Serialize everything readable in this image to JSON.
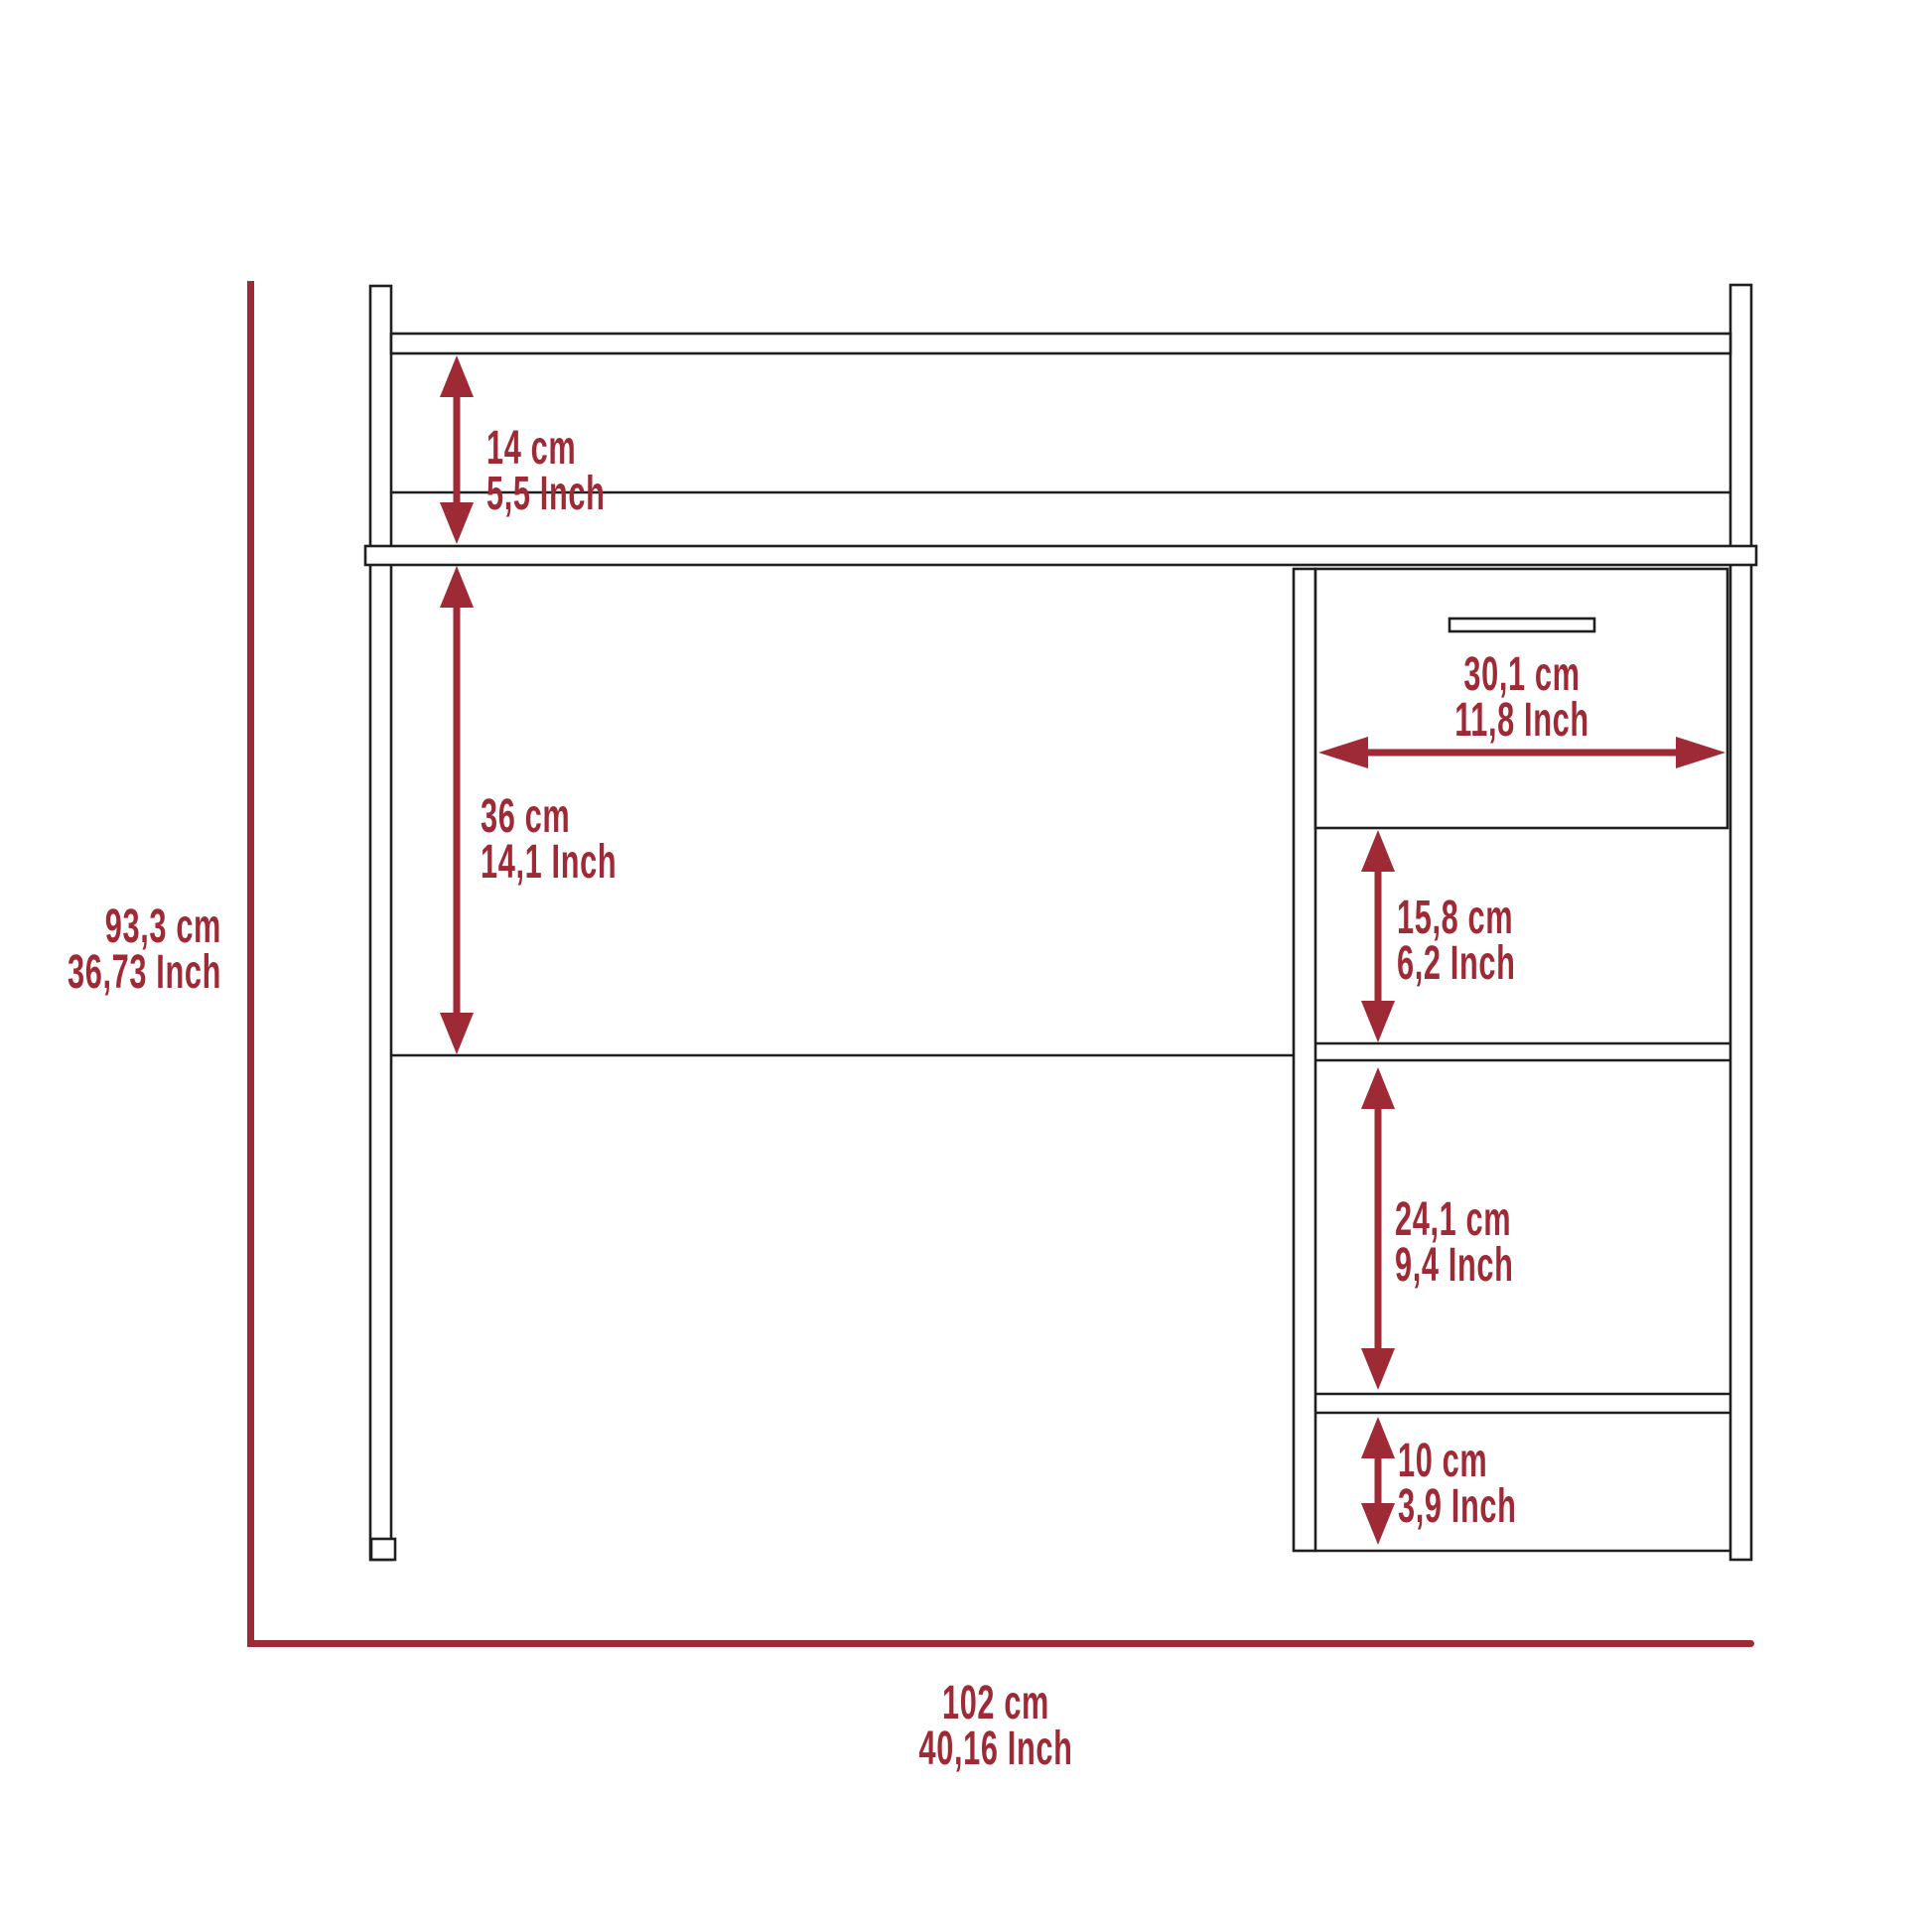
{
  "diagram": {
    "subject": "desk-dimension-diagram",
    "colors": {
      "accent": "#9e2a36",
      "line": "#1f1f1f",
      "background": "#ffffff"
    },
    "dimensions": {
      "overall_height": {
        "cm": "93,3 cm",
        "inch": "36,73 Inch"
      },
      "overall_width": {
        "cm": "102 cm",
        "inch": "40,16 Inch"
      },
      "hutch_clearance": {
        "cm": "14 cm",
        "inch": "5,5 Inch"
      },
      "desk_clearance": {
        "cm": "36 cm",
        "inch": "14,1 Inch"
      },
      "drawer_width": {
        "cm": "30,1 cm",
        "inch": "11,8 Inch"
      },
      "upper_shelf_space": {
        "cm": "15,8 cm",
        "inch": "6,2 Inch"
      },
      "middle_shelf_space": {
        "cm": "24,1 cm",
        "inch": "9,4 Inch"
      },
      "bottom_shelf_space": {
        "cm": "10 cm",
        "inch": "3,9 Inch"
      }
    }
  }
}
